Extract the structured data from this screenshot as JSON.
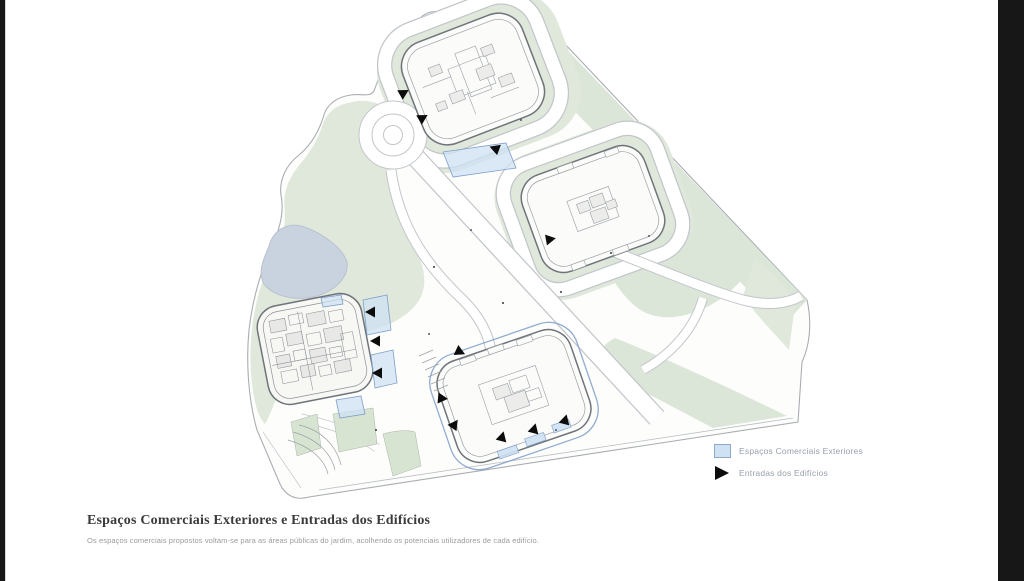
{
  "frame": {
    "letterbox_color": "#171717",
    "stage_background": "#ffffff"
  },
  "title_block": {
    "title": "Espaços Comerciais Exteriores e Entradas dos Edifícios",
    "subtitle": "Os espaços comerciais propostos voltam-se para as áreas públicas do jardim, acolhendo os potenciais utilizadores de cada edifício."
  },
  "legend": {
    "items": [
      {
        "label": "Espaços Comerciais Exteriores",
        "swatch": "blue-square-icon",
        "color": "#cfe2f4",
        "border": "#8fa8c8"
      },
      {
        "label": "Entradas dos Edifícios",
        "swatch": "black-triangle-icon",
        "color": "#0c0c0c"
      }
    ]
  },
  "plan": {
    "description": "Axonometric site plan: four courtyard buildings, public garden with pond, roundabout, diagonal pedestrian roads, exterior commercial spaces (blue) and building entrances (black arrows)",
    "colors": {
      "green": "#dfe8da",
      "green_dark": "#d8e4d2",
      "pond": "#c9d2df",
      "path_edge": "#c2c6ca",
      "site_edge": "#a9adb2",
      "building_line": "#6f747b",
      "commercial_blue": "#cfe2f4",
      "commercial_blue_border": "#7e9ec9",
      "entrance_black": "#0c0c0c"
    }
  }
}
